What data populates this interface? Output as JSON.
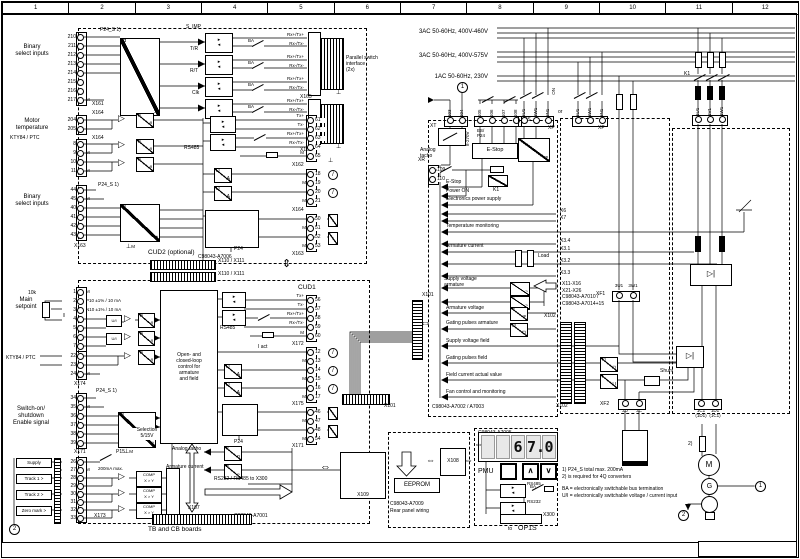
{
  "ruler": [
    "1",
    "2",
    "3",
    "4",
    "5",
    "6",
    "7",
    "8",
    "9",
    "10",
    "11",
    "12"
  ],
  "power": {
    "l1": "3AC 50-60Hz, 400V-460V",
    "l2": "3AC 50-60Hz, 400V-575V",
    "l3": "1AC 50-60Hz, 230V"
  },
  "boards": {
    "cud2": "CUD2 (optional)",
    "cud1": "CUD1",
    "a7001": "C98043-A7001",
    "a7006": "C98043-A7006",
    "a7002": "C98043-A7002 / A7003",
    "a7005": "C98043-A7005",
    "a7009a": "C98043-A7009",
    "a7009b": "Rear panel wiring",
    "a7010a": "C98043-A7010 /",
    "a7010b": "C98043-A7014+15",
    "tb": "TB and CB boards"
  },
  "conn": {
    "x161": "X161",
    "x162": "X162",
    "x163": "X163",
    "x164": "X164",
    "x165": "X165",
    "x166": "X166",
    "x171": "X171",
    "x172": "X172",
    "x173": "X173",
    "x174": "X174",
    "x175": "X175",
    "x101": "X101",
    "x102": "X102",
    "x107": "X107",
    "x108": "X108",
    "x109": "X109",
    "x110": "X110 / X111",
    "x300": "X300",
    "xt": "XT",
    "xs": "XS",
    "xp": "XP",
    "xr": "XR",
    "xf1": "XF1",
    "xf2": "XF2",
    "x6": "X6",
    "x7": "X7",
    "x34": "X3.4",
    "x31": "X3.1",
    "x32": "X3.2",
    "x33": "X3.3",
    "x1116": "X11-X16",
    "x2126": "X21-X26"
  },
  "sig": {
    "txp": "Tx+",
    "txm": "Tx-",
    "rxp": "Rx+/Tx+",
    "rxm": "Rx-/Tx-",
    "m": "M",
    "ba": "BA",
    "simp": "S_IMP",
    "tr": "T/R",
    "rt": "R/T",
    "clk": "Clk",
    "iact": "I act"
  },
  "labels": {
    "bin1": "Binary\nselect inputs",
    "mot": "Motor\ntemperature",
    "kty": "KTY84 / PTC",
    "main": "Main\nsetpoint",
    "r10k": "10k",
    "sw": "Switch-on/\nshutdown\nEnable signal",
    "sup": "Supply",
    "tr1": "Track 1 >",
    "tr2": "Track 2 >",
    "zm": "Zero mark >",
    "open": "Open- and\nclosed-loop\ncontrol for\narmature\nand field",
    "atacho": "Analog tacho",
    "atacho2": "Analog\ntacho",
    "acur": "Armature current",
    "estop": "E-Stop",
    "pon": "Power ON",
    "eps": "Electronics power supply",
    "tmon": "Temperature monitoring",
    "sva": "Supply voltage\narmature",
    "av": "Armature voltage",
    "gpa": "Gating pulses armature",
    "svf": "Supply voltage field",
    "gpf": "Gating pulses field",
    "fca": "Field current actual value",
    "fan": "Fan control and monitoring",
    "par": "Parallel switch\ninterface\n(2x)",
    "sel": "Selection\n5/15V",
    "comp1": "COMP",
    "comp2": "X > Y"
  },
  "misc": {
    "or": "or",
    "on": "ON",
    "k1": "K1",
    "p24": "P24",
    "p24s": "P24_S 1)",
    "p15": "P15",
    "p15max": "200mA max.",
    "v8270": "8-270V",
    "load": "Load",
    "shunt": "Shunt",
    "esp24": "ES/\nP24",
    "toop": "to",
    "op1s": "OP1S",
    "rs485": "RS485",
    "rs232": "RS232",
    "rsx": "RS232 / RS485 to X300",
    "eeprom": "EEPROM",
    "motor": "M",
    "gen": "G",
    "c1": "1",
    "c2": "2",
    "f2": "2)",
    "gndm": "M"
  },
  "glyphs": {
    "n": "n",
    "h": "#",
    "d": "D",
    "a": "A",
    "sin": "~",
    "eq": "=",
    "f": "f",
    "u": "U",
    "pu": "⊓",
    "ui": "U/I"
  },
  "pmu": {
    "label": "PMU",
    "digits": [
      "",
      "",
      "6",
      "7.",
      "0"
    ],
    "up": "∧",
    "down": "∨"
  },
  "notes": {
    "n1": "1) P24_S total max. 200mA",
    "n2": "2) is required for 4Q converters",
    "n3": "BA = electronically switchable bus termination",
    "n4": "U/I = electronically switchable voltage / current input"
  },
  "terms": {
    "x161": [
      {
        "n": "210",
        "note": ""
      },
      {
        "n": "211",
        "note": ""
      },
      {
        "n": "212",
        "note": ""
      },
      {
        "n": "213",
        "note": ""
      },
      {
        "n": "214",
        "note": ""
      },
      {
        "n": "215",
        "note": ""
      },
      {
        "n": "216",
        "note": ""
      },
      {
        "n": "217",
        "note": "M"
      }
    ],
    "x164a": [
      {
        "n": "204",
        "note": ""
      },
      {
        "n": "205",
        "note": ""
      }
    ],
    "x164b": [
      {
        "n": "8",
        "note": ""
      },
      {
        "n": "9",
        "note": "M"
      },
      {
        "n": "10",
        "note": ""
      },
      {
        "n": "11",
        "note": "M"
      }
    ],
    "x163a": [
      {
        "n": "44",
        "note": ""
      },
      {
        "n": "45",
        "note": "M"
      },
      {
        "n": "40",
        "note": ""
      },
      {
        "n": "41",
        "note": ""
      },
      {
        "n": "42",
        "note": ""
      },
      {
        "n": "43",
        "note": ""
      }
    ],
    "x162": [
      {
        "n": "61",
        "note": ""
      },
      {
        "n": "62",
        "note": ""
      },
      {
        "n": "63",
        "note": ""
      },
      {
        "n": "64",
        "note": ""
      },
      {
        "n": "65",
        "note": ""
      }
    ],
    "x164c": [
      {
        "n": "18",
        "note": ""
      },
      {
        "n": "19",
        "note": "M"
      },
      {
        "n": "20",
        "note": ""
      },
      {
        "n": "21",
        "note": "M"
      }
    ],
    "x163b": [
      {
        "n": "50",
        "note": ""
      },
      {
        "n": "51",
        "note": "M"
      },
      {
        "n": "52",
        "note": ""
      },
      {
        "n": "53",
        "note": "M"
      }
    ],
    "x174": [
      {
        "n": "1",
        "note": "M"
      },
      {
        "n": "2",
        "note": "P10 ±1% / 10 mA"
      },
      {
        "n": "3",
        "note": "N10 ±1% / 10 mA"
      },
      {
        "n": "4",
        "note": ""
      },
      {
        "n": "5",
        "note": ""
      },
      {
        "n": "6",
        "note": ""
      },
      {
        "n": "7",
        "note": ""
      }
    ],
    "x174b": [
      {
        "n": "22",
        "note": ""
      },
      {
        "n": "23",
        "note": ""
      },
      {
        "n": "24",
        "note": "M"
      }
    ],
    "x171a": [
      {
        "n": "34",
        "note": ""
      },
      {
        "n": "35",
        "note": "M"
      },
      {
        "n": "36",
        "note": ""
      },
      {
        "n": "37",
        "note": ""
      },
      {
        "n": "38",
        "note": ""
      },
      {
        "n": "39",
        "note": ""
      }
    ],
    "x173": [
      {
        "n": "26",
        "note": ""
      },
      {
        "n": "27",
        "note": "M"
      },
      {
        "n": "28",
        "note": ""
      },
      {
        "n": "29",
        "note": ""
      },
      {
        "n": "30",
        "note": ""
      },
      {
        "n": "31",
        "note": ""
      },
      {
        "n": "32",
        "note": ""
      },
      {
        "n": "33",
        "note": ""
      }
    ],
    "x172": [
      {
        "n": "56",
        "note": ""
      },
      {
        "n": "57",
        "note": ""
      },
      {
        "n": "58",
        "note": ""
      },
      {
        "n": "59",
        "note": ""
      },
      {
        "n": "60",
        "note": ""
      }
    ],
    "x175": [
      {
        "n": "12",
        "note": ""
      },
      {
        "n": "13",
        "note": "M"
      },
      {
        "n": "14",
        "note": ""
      },
      {
        "n": "15",
        "note": "M"
      },
      {
        "n": "16",
        "note": ""
      },
      {
        "n": "17",
        "note": "M"
      }
    ],
    "x171b": [
      {
        "n": "46",
        "note": ""
      },
      {
        "n": "47",
        "note": "M"
      },
      {
        "n": "48",
        "note": ""
      },
      {
        "n": "54",
        "note": "M"
      }
    ],
    "xt": [
      {
        "n": "103"
      },
      {
        "n": "104"
      }
    ],
    "xs": [
      {
        "n": "105"
      },
      {
        "n": "106"
      },
      {
        "n": "107"
      },
      {
        "n": "108"
      }
    ],
    "xp1": [
      {
        "n": "5U1"
      },
      {
        "n": "5W1"
      },
      {
        "n": "5N1"
      }
    ],
    "xp2": [
      {
        "n": "5U1"
      },
      {
        "n": "5W1"
      },
      {
        "n": "5N1"
      }
    ],
    "xr": [
      {
        "n": "109",
        "note": ""
      },
      {
        "n": "110",
        "note": ""
      }
    ],
    "x1u": [
      {
        "n": "1U1"
      },
      {
        "n": "1V1"
      },
      {
        "n": "1W1"
      }
    ],
    "xf1": [
      {
        "n": "3U1"
      },
      {
        "n": "3W1"
      }
    ],
    "xf2": [
      {
        "n": "3D"
      },
      {
        "n": "3C"
      }
    ],
    "xout": [
      {
        "n": "1C1",
        "note": "(1D1)"
      },
      {
        "n": "1D1",
        "note": "(1C1)"
      }
    ]
  }
}
